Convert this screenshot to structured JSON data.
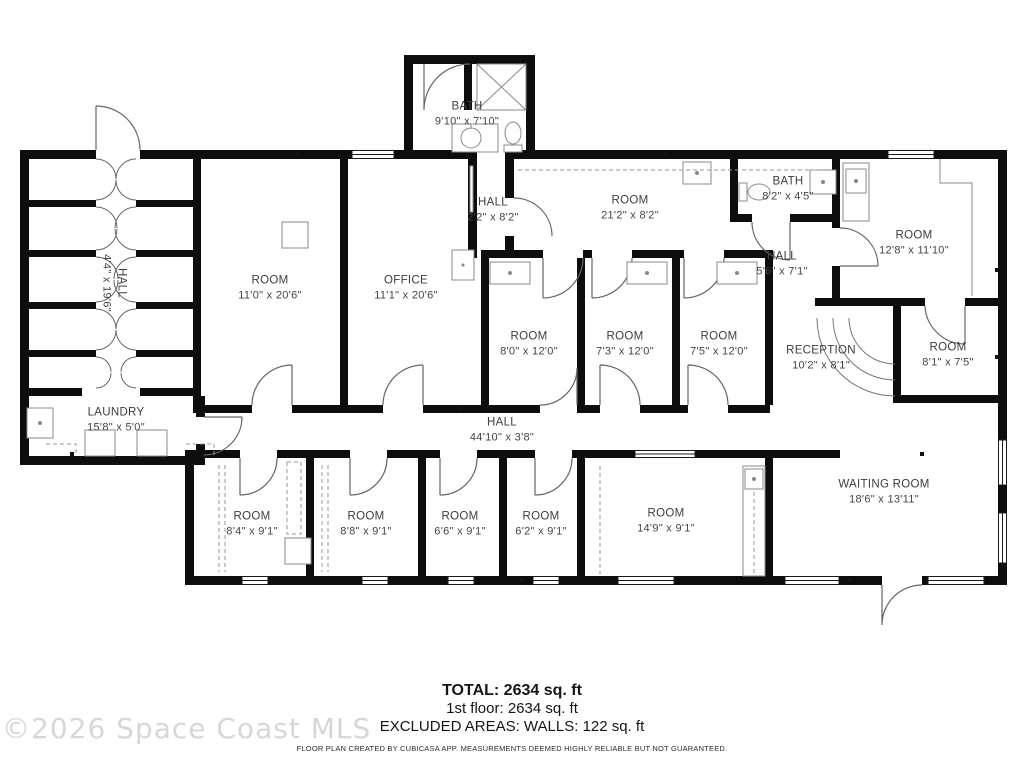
{
  "watermark": "©2026 Space Coast MLS",
  "footer": {
    "total": "TOTAL: 2634 sq. ft",
    "floor": "1st floor: 2634 sq. ft",
    "excluded": "EXCLUDED AREAS: WALLS: 122 sq. ft",
    "disclaimer": "FLOOR PLAN CREATED BY CUBICASA APP. MEASUREMENTS DEEMED HIGHLY RELIABLE BUT NOT GUARANTEED."
  },
  "rooms": [
    {
      "name": "BATH",
      "dims": "9'10\" x 7'10\""
    },
    {
      "name": "HALL",
      "dims": "2'2\" x 8'2\""
    },
    {
      "name": "ROOM",
      "dims": "21'2\" x 8'2\""
    },
    {
      "name": "BATH",
      "dims": "8'2\" x 4'5\""
    },
    {
      "name": "HALL",
      "dims": "5'6\" x 7'1\""
    },
    {
      "name": "ROOM",
      "dims": "12'8\" x 11'10\""
    },
    {
      "name": "ROOM",
      "dims": "11'0\" x 20'6\""
    },
    {
      "name": "OFFICE",
      "dims": "11'1\" x 20'6\""
    },
    {
      "name": "ROOM",
      "dims": "8'0\" x 12'0\""
    },
    {
      "name": "ROOM",
      "dims": "7'3\" x 12'0\""
    },
    {
      "name": "ROOM",
      "dims": "7'5\" x 12'0\""
    },
    {
      "name": "RECEPTION",
      "dims": "10'2\" x 8'1\""
    },
    {
      "name": "ROOM",
      "dims": "8'1\" x 7'5\""
    },
    {
      "name": "HALL",
      "dims": "4'4\" x 19'6\""
    },
    {
      "name": "LAUNDRY",
      "dims": "15'8\" x 5'0\""
    },
    {
      "name": "HALL",
      "dims": "44'10\" x 3'8\""
    },
    {
      "name": "ROOM",
      "dims": "8'4\" x 9'1\""
    },
    {
      "name": "ROOM",
      "dims": "8'8\" x 9'1\""
    },
    {
      "name": "ROOM",
      "dims": "6'6\" x 9'1\""
    },
    {
      "name": "ROOM",
      "dims": "6'2\" x 9'1\""
    },
    {
      "name": "ROOM",
      "dims": "14'9\" x 9'1\""
    },
    {
      "name": "WAITING ROOM",
      "dims": "18'6\" x 13'11\""
    }
  ]
}
